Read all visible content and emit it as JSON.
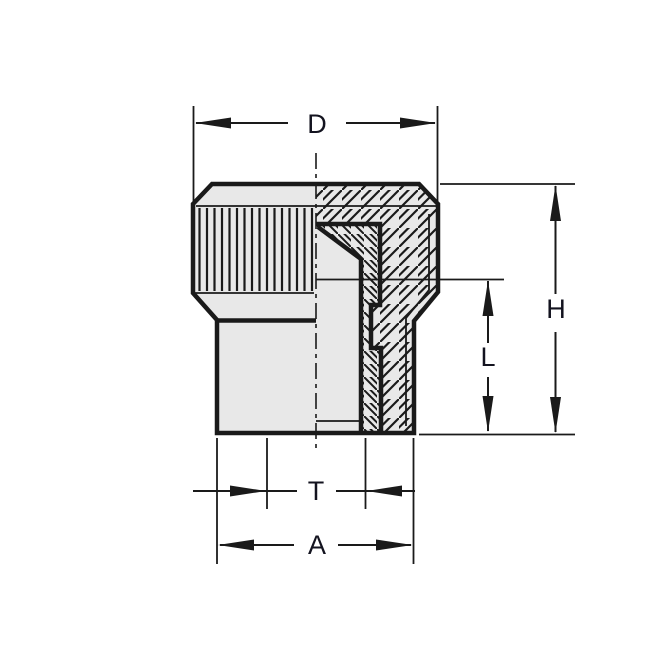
{
  "figure": {
    "labels": {
      "top_width": "D",
      "overall_height": "H",
      "insert_length": "L",
      "bore": "T",
      "base_width": "A"
    },
    "colors": {
      "background": "#ffffff",
      "line": "#1a1a1a",
      "face": "#e8e8e8",
      "label_text": "#13131f"
    }
  }
}
